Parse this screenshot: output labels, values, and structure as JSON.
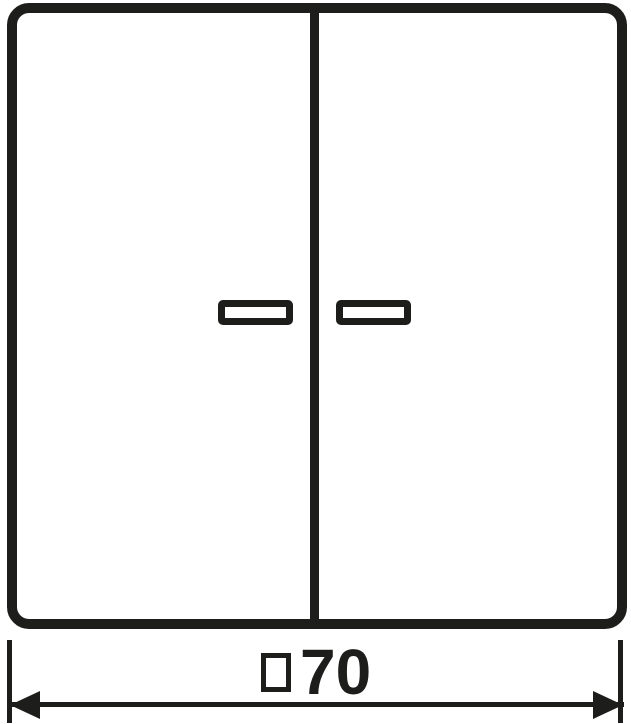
{
  "colors": {
    "line": "#1d1d1b",
    "background": "#ffffff"
  },
  "drawing": {
    "type": "technical dimension drawing",
    "subject": "two-gang rocker switch cover with indicator windows, front view",
    "shapes": {
      "plate": "rounded square outline",
      "divider": "vertical center split line",
      "left_window": "outlined rectangle lens",
      "right_window": "outlined rectangle lens",
      "dimension_markers": "double-headed arrow between two extension lines"
    },
    "dimension": {
      "symbol": "□",
      "value": "70",
      "label": "□70"
    }
  }
}
